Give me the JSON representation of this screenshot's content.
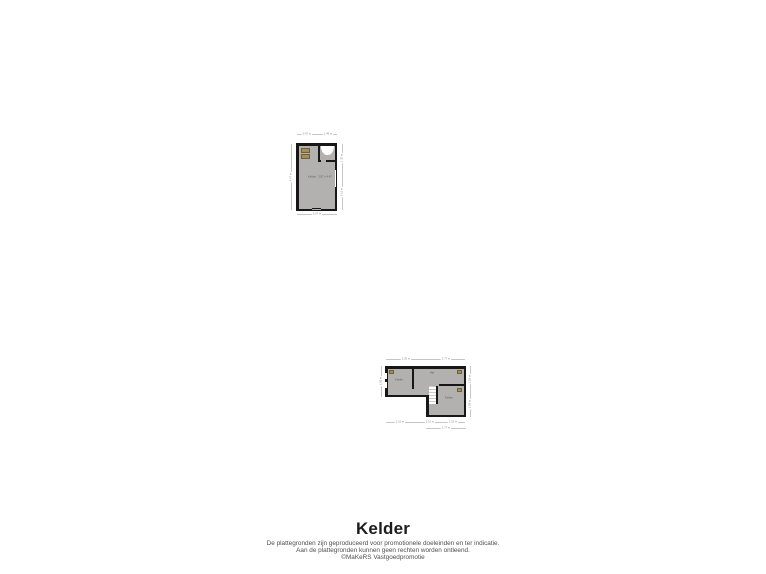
{
  "title": "Kelder",
  "disclaimer": {
    "line1": "De plattegronden zijn geproduceerd voor promotionele doeleinden en ter indicatie.",
    "line2": "Aan de plattegronden kunnen geen rechten worden ontleend.",
    "line3": "©MaKeRS Vastgoedpromotie"
  },
  "colors": {
    "wall": "#171717",
    "floor": "#b2b1b0",
    "fixture": "#a38f55",
    "dimension_text": "#8d8d8d",
    "background": "#ffffff"
  },
  "upper_plan": {
    "room": {
      "label": "Kelder",
      "size": "2.57 x 4.47"
    },
    "dims": {
      "top_left": "0.97 m",
      "top_right": "1.49 m",
      "bottom": "2.57 m",
      "left": "4.47 m",
      "right_top": "1.32 m",
      "right_bottom": "3.15 m"
    }
  },
  "lower_plan": {
    "rooms": {
      "left": "Kelder",
      "middle": "Hal",
      "right": "Kelder"
    },
    "dims": {
      "top_left": "2.55 m",
      "top_right": "3.77 m",
      "left": "1.55 m",
      "right_top": "1.55 m",
      "right_bottom": "1.08 m",
      "bottom_a": "1.10 m",
      "bottom_b": "2.10 m",
      "bottom_c": "1.52 m",
      "bottom_ext": "3.77 m"
    }
  }
}
